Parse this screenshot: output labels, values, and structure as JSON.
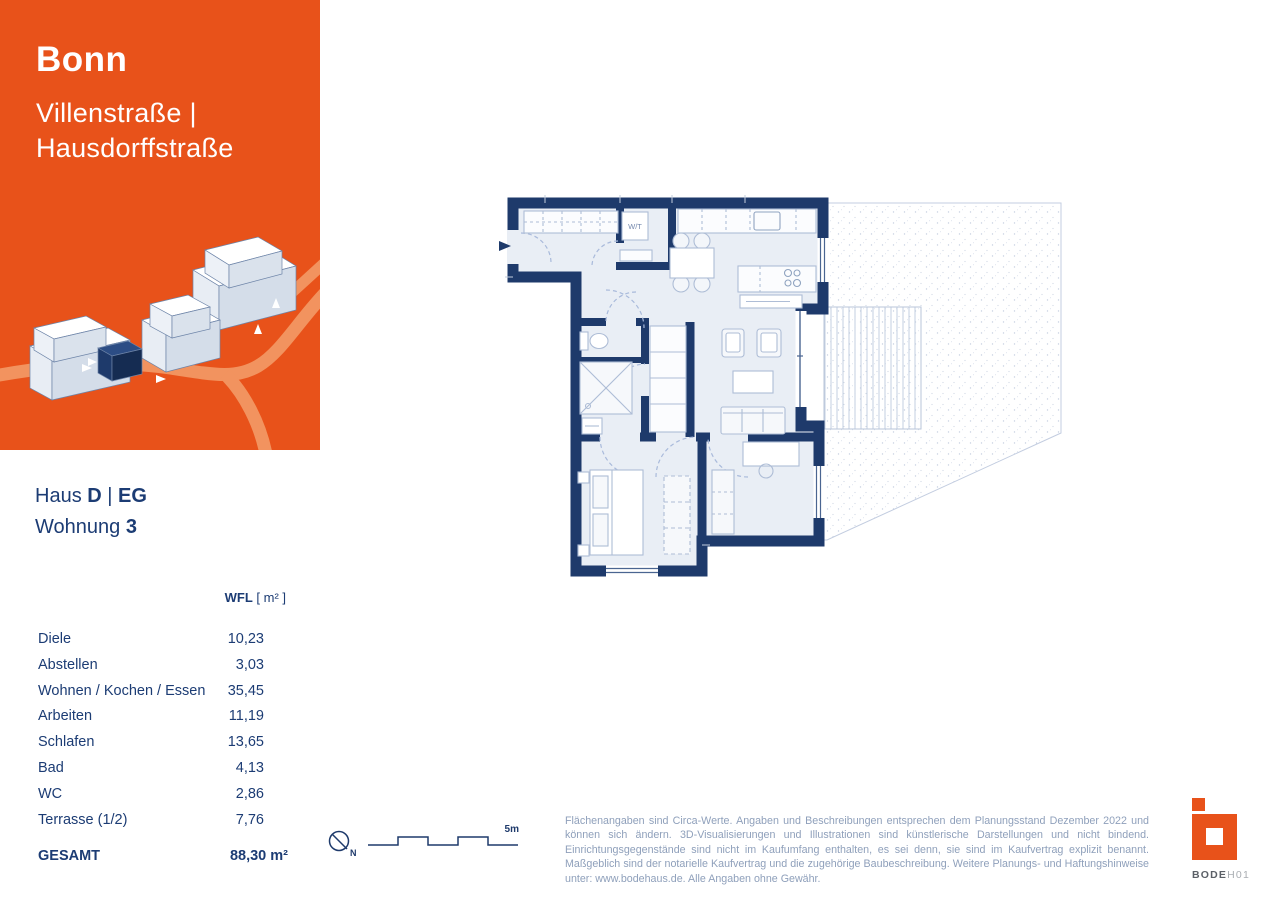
{
  "panel": {
    "city": "Bonn",
    "street_line1": "Villenstraße |",
    "street_line2": "Hausdorffstraße",
    "accent_color": "#E8521A"
  },
  "unit": {
    "haus_label": "Haus",
    "haus_value": "D",
    "separator": "|",
    "floor_value": "EG",
    "wohnung_label": "Wohnung",
    "wohnung_value": "3"
  },
  "table": {
    "header_bold": "WFL",
    "header_unit": "[ m² ]",
    "rows": [
      {
        "label": "Diele",
        "value": "10,23"
      },
      {
        "label": "Abstellen",
        "value": "3,03"
      },
      {
        "label": "Wohnen / Kochen / Essen",
        "value": "35,45"
      },
      {
        "label": "Arbeiten",
        "value": "11,19"
      },
      {
        "label": "Schlafen",
        "value": "13,65"
      },
      {
        "label": "Bad",
        "value": "4,13"
      },
      {
        "label": "WC",
        "value": "2,86"
      },
      {
        "label": "Terrasse (1/2)",
        "value": "7,76"
      }
    ],
    "total_label": "GESAMT",
    "total_value": "88,30 m²"
  },
  "floorplan": {
    "wt_label": "W/T",
    "north_label": "N",
    "scale_label": "5m",
    "wall_color": "#1E3A6B",
    "room_fill": "#E9EEF5"
  },
  "disclaimer": "Flächenangaben sind Circa-Werte. Angaben und Beschreibungen entsprechen dem Planungsstand Dezember 2022 und können sich ändern. 3D-Visualisierungen und Illustrationen sind künstlerische Darstellungen und nicht bindend. Einrichtungsgegenstände sind nicht im Kaufumfang enthalten, es sei denn, sie sind im Kaufvertrag explizit benannt. Maßgeblich sind der notarielle Kaufvertrag und die zugehörige Baubeschreibung. Weitere Planungs- und Haftungshinweise unter: www.bodehaus.de. Alle Angaben ohne Gewähr.",
  "brand": {
    "name_bold": "BODE",
    "name_light": "H01"
  }
}
